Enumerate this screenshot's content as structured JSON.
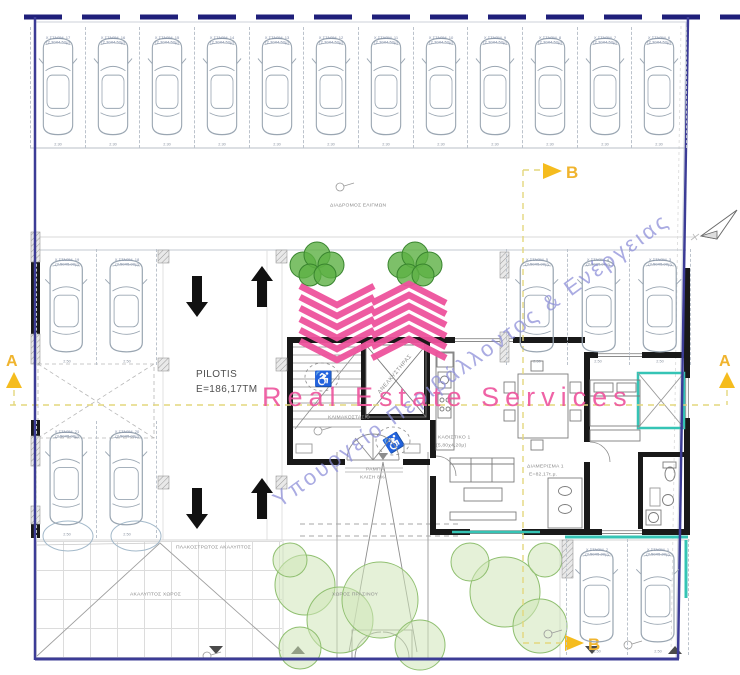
{
  "plan": {
    "pilotis": {
      "title": "PILOTIS",
      "area": "E=186,17TM"
    },
    "section_markers": {
      "a": "A",
      "b": "B"
    },
    "watermark": {
      "brand": "Real Estate Services",
      "ministry": "Υπουργείο Περιβάλλοντος & Ενέργειας"
    },
    "annotations": {
      "driveway": "ΔΙΑΔΡΟΜΟΣ ΕΛΙΓΜΩΝ",
      "paved_open": "ΠΛΑΚΟΣΤΡΩΤΟΣ ΑΚΑΛΥΠΤΟΣ",
      "open_space": "ΑΚΑΛΥΠΤΟΣ ΧΩΡΟΣ",
      "green": "ΧΩΡΟΣ ΠΡΑΣΙΝΟΥ",
      "ramp_l1": "ΡΑΜΠΑ",
      "ramp_l2": "ΚΛΙΣΗ 8%",
      "stairwell": "ΚΛΙΜΑΚΟΣΤΑΣΙΟ",
      "elevator": "ΑΝΕΛΚΥΣΤΗΡΑΣ",
      "apartment": "ΔΙΑΜΕΡΙΣΜΑ 1",
      "apartment_area": "Ε=82,17τ.μ.",
      "living": "ΚΑΘΙΣΤΙΚΟ 1",
      "living_dims": "(5,80χ4,20μ)"
    },
    "parking": {
      "groups": [
        {
          "id": "top-row",
          "stalls": [
            {
              "n": "Χ.ΣΤΑΘΜ. 17",
              "d": "(2,30Χ4,50μ)",
              "w": "2.30"
            },
            {
              "n": "Χ.ΣΤΑΘΜ. 16",
              "d": "(2,30Χ4,50μ)",
              "w": "2.30"
            },
            {
              "n": "Χ.ΣΤΑΘΜ. 15",
              "d": "(2,30Χ4,50μ)",
              "w": "2.30"
            },
            {
              "n": "Χ.ΣΤΑΘΜ. 14",
              "d": "(2,30Χ4,50μ)",
              "w": "2.30"
            },
            {
              "n": "Χ.ΣΤΑΘΜ. 13",
              "d": "(2,30Χ4,50μ)",
              "w": "2.30"
            },
            {
              "n": "Χ.ΣΤΑΘΜ. 12",
              "d": "(2,30Χ4,50μ)",
              "w": "2.30"
            },
            {
              "n": "Χ.ΣΤΑΘΜ. 11",
              "d": "(2,30Χ4,50μ)",
              "w": "2.30"
            },
            {
              "n": "Χ.ΣΤΑΘΜ. 10",
              "d": "(2,30Χ4,50μ)",
              "w": "2.30"
            },
            {
              "n": "Χ.ΣΤΑΘΜ. 9",
              "d": "(2,30Χ4,50μ)",
              "w": "2.30"
            },
            {
              "n": "Χ.ΣΤΑΘΜ. 8",
              "d": "(2,30Χ4,50μ)",
              "w": "2.30"
            },
            {
              "n": "Χ.ΣΤΑΘΜ. 7",
              "d": "(2,30Χ4,50μ)",
              "w": "2.30"
            },
            {
              "n": "Χ.ΣΤΑΘΜ. 6",
              "d": "(2,30Χ4,50μ)",
              "w": "2.30"
            }
          ]
        },
        {
          "id": "mid-left",
          "stalls": [
            {
              "n": "Χ.ΣΤΑΘΜ. 19",
              "d": "(2,50Χ5,00μ)",
              "w": "2.50"
            },
            {
              "n": "Χ.ΣΤΑΘΜ. 18",
              "d": "(2,50Χ5,00μ)",
              "w": "2.50"
            }
          ]
        },
        {
          "id": "mid-right",
          "stalls": [
            {
              "n": "Χ.ΣΤΑΘΜ. 5",
              "d": "(2,50Χ5,00μ)",
              "w": "2.50"
            },
            {
              "n": "Χ.ΣΤΑΘΜ. 4",
              "d": "(2,50Χ5,00μ)",
              "w": "2.50"
            },
            {
              "n": "Χ.ΣΤΑΘΜ. 3",
              "d": "(2,50Χ5,00μ)",
              "w": "2.50"
            }
          ]
        },
        {
          "id": "lower-left",
          "stalls": [
            {
              "n": "Χ.ΣΤΑΘΜ. 21",
              "d": "(2,50Χ5,00μ)",
              "w": "2.50"
            },
            {
              "n": "Χ.ΣΤΑΘΜ. 20",
              "d": "(2,50Χ5,00μ)",
              "w": "2.50"
            }
          ]
        },
        {
          "id": "bottom-right",
          "stalls": [
            {
              "n": "Χ.ΣΤΑΘΜ. 2",
              "d": "(2,50Χ5,00μ)",
              "w": "2.50"
            },
            {
              "n": "Χ.ΣΤΑΘΜ. 1",
              "d": "(2,50Χ5,00μ)",
              "w": "2.50"
            }
          ]
        }
      ]
    },
    "colors": {
      "boundary_navy": "#1f1f7a",
      "section_yellow": "#e3d77d",
      "marker_yellow": "#f0b42e",
      "brand_pink": "#ee539d",
      "watermark_purple": "#8a8cd8",
      "teal": "#35c4b5",
      "wall_black": "#191919",
      "car_line": "#9aa6b2",
      "tree_dark": "#4ba03c",
      "tree_light": "#a9cf8e"
    }
  }
}
